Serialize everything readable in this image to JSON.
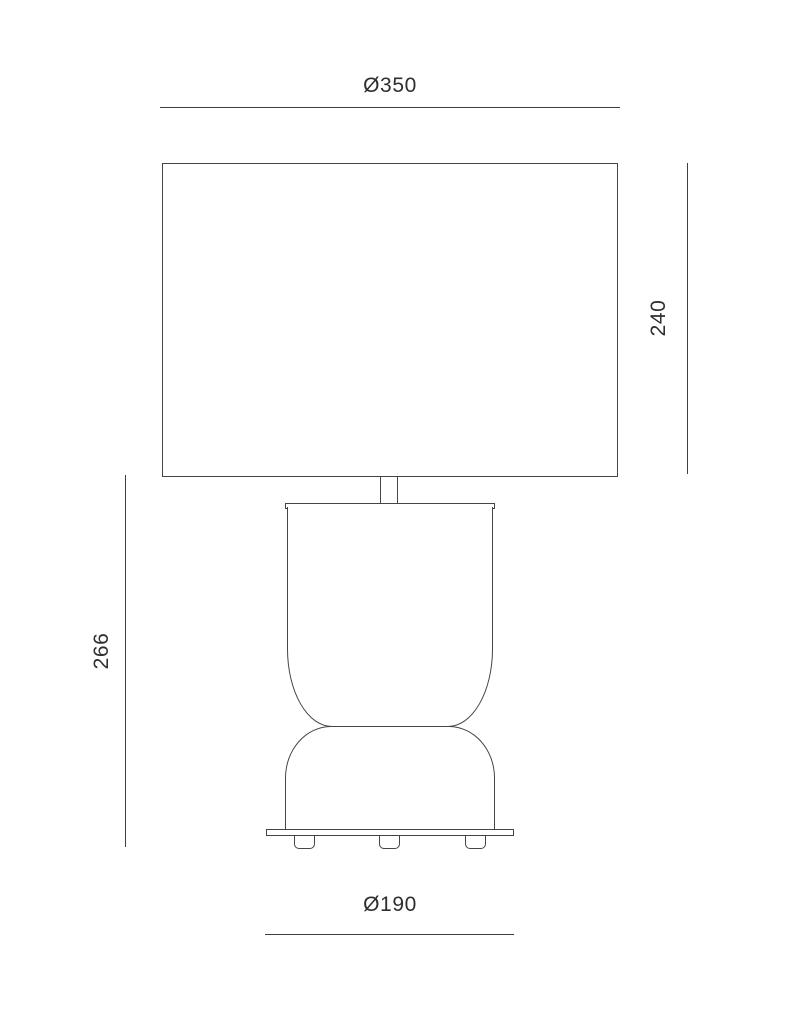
{
  "colors": {
    "outline": "#454545",
    "dimension_line": "#3f3f3f",
    "text": "#2f2f2f",
    "background": "#ffffff"
  },
  "dimension_labels": {
    "shade_diameter": "Ø350",
    "shade_height": "240",
    "body_height": "266",
    "base_diameter": "Ø190"
  }
}
